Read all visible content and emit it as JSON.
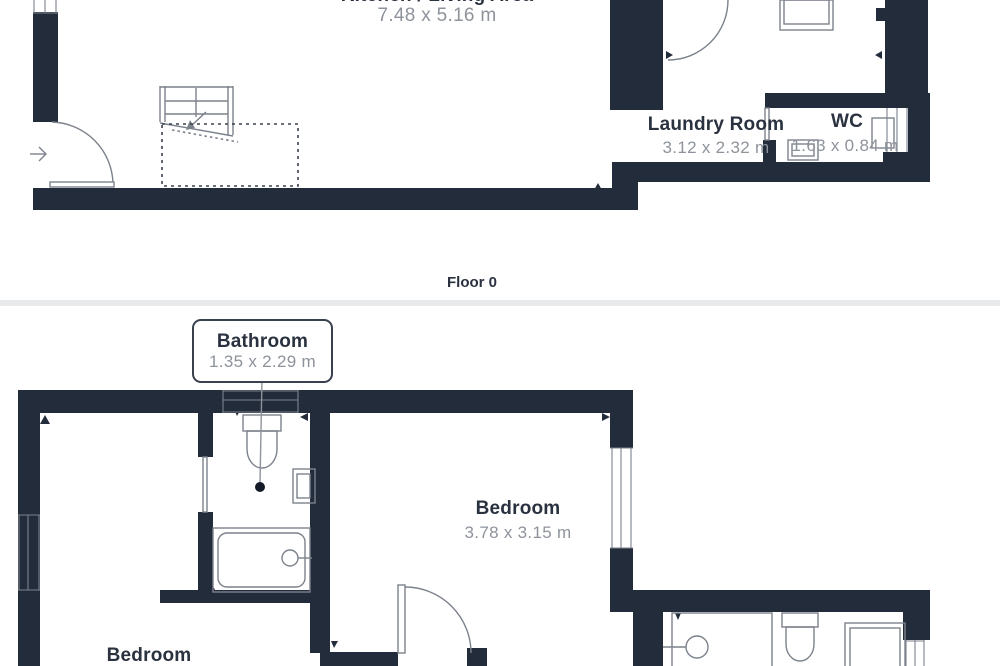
{
  "colors": {
    "wall": "#232C3B",
    "fixture": "#7C828C",
    "label": "#2A3240",
    "dims": "#8E939B",
    "separator": "#E8E9EB",
    "dashed": "#39414F",
    "dot": "#141B26"
  },
  "floor0": {
    "caption": "Floor 0",
    "kitchen_living": {
      "label": "Kitchen / Living Area",
      "dims": "7.48 x 5.16 m"
    },
    "laundry": {
      "label": "Laundry Room",
      "dims": "3.12 x 2.32 m"
    },
    "wc": {
      "label": "WC",
      "dims": "1.63 x 0.84 m"
    }
  },
  "floor1": {
    "bathroom": {
      "label": "Bathroom",
      "dims": "1.35 x 2.29 m"
    },
    "bedroom_main": {
      "label": "Bedroom",
      "dims": "3.78 x 3.15 m"
    },
    "bedroom_second": {
      "label": "Bedroom"
    }
  }
}
